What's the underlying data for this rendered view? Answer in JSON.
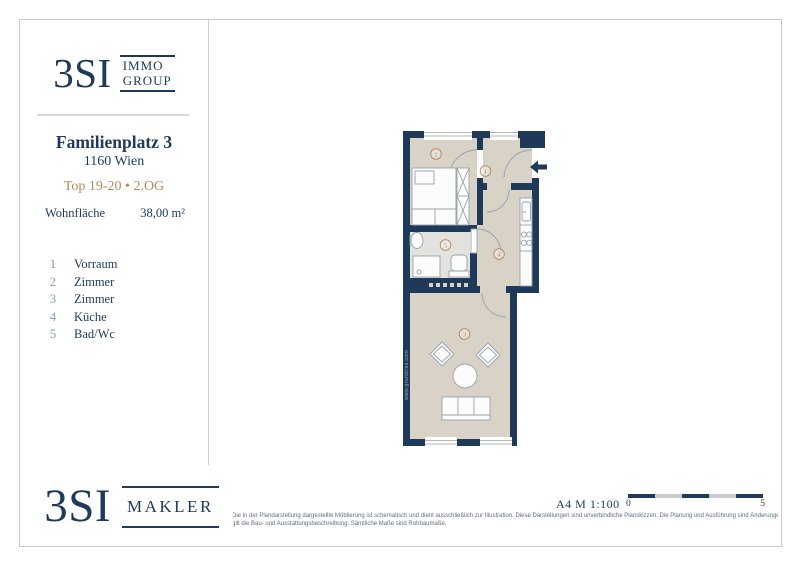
{
  "sidebar": {
    "logo": {
      "brand": "3SI",
      "word1": "IMMO",
      "word2": "GROUP"
    },
    "address_line1": "Familienplatz 3",
    "address_line2": "1160 Wien",
    "unit_line": "Top 19-20 • 2.OG",
    "area_label": "Wohnfläche",
    "area_value": "38,00 m²",
    "rooms": [
      {
        "no": "1",
        "name": "Vorraum"
      },
      {
        "no": "2",
        "name": "Zimmer"
      },
      {
        "no": "3",
        "name": "Zimmer"
      },
      {
        "no": "4",
        "name": "Küche"
      },
      {
        "no": "5",
        "name": "Bad/Wc"
      }
    ]
  },
  "plan": {
    "room_labels": {
      "r1": "1",
      "r2": "2",
      "r3": "3",
      "r4": "4",
      "r5": "5"
    },
    "watermark": "www.grundriss.com"
  },
  "footer": {
    "logo": {
      "brand": "3SI",
      "word": "MAKLER"
    },
    "sheet_info": "A4  M 1:100",
    "scale_start": "0",
    "scale_end": "5",
    "disclaimer_line1": "Die in der Plandarstellung dargestellte Möblierung ist schematisch und dient ausschließlich zur Illustration. Diese Darstellungen sind unverbindliche Planskizzen. Die Planung und Ausführung sind Änderungen vorbehalten. Es",
    "disclaimer_line2": "gilt die Bau- und Ausstattungsbeschreibung. Sämtliche Maße sind Rohbaumaße."
  },
  "colors": {
    "navy": "#1e3a58",
    "tan": "#b2895e",
    "floor": "#d8d2c7",
    "bath_floor": "#e2e3df"
  }
}
